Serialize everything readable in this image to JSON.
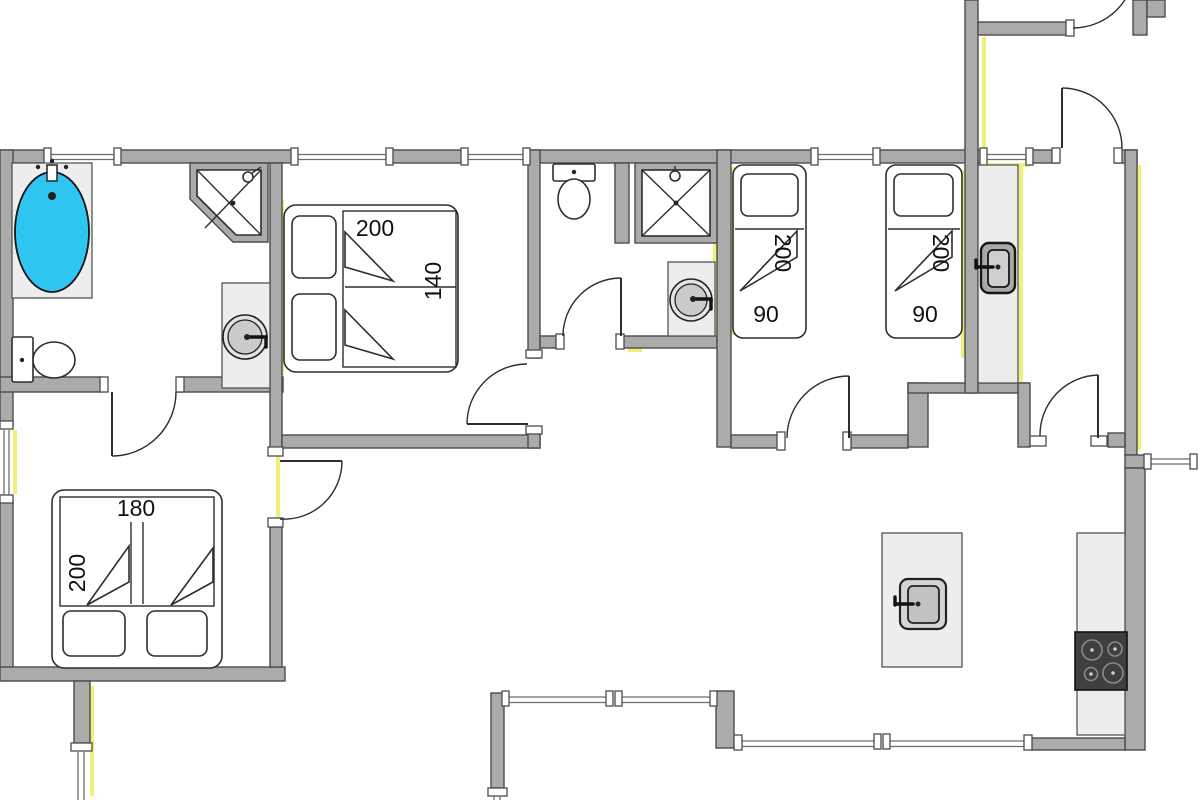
{
  "title": "Holiday home floor plan",
  "labels": {
    "double_bed_length": "200",
    "double_bed_width": "140",
    "single_bed_a_length": "200",
    "single_bed_a_width": "90",
    "single_bed_b_length": "200",
    "single_bed_b_width": "90",
    "twin_bed_width": "180",
    "twin_bed_length": "200"
  },
  "colors": {
    "wall_fill": "#ababab",
    "wall_outline": "#4c4c4c",
    "window_accent": "#f2ee78",
    "bathtub_water": "#2ec6f0",
    "counter_fill": "#ededed",
    "stove_fill": "#3f3f3f"
  },
  "icons": {
    "bathtub": "bathtub-icon",
    "corner_shower": "corner-shower-icon",
    "toilet": "toilet-icon",
    "round_sink": "round-sink-icon",
    "rect_sink": "rect-sink-icon",
    "stove": "stove-icon",
    "door_swing": "door-swing-arc"
  }
}
